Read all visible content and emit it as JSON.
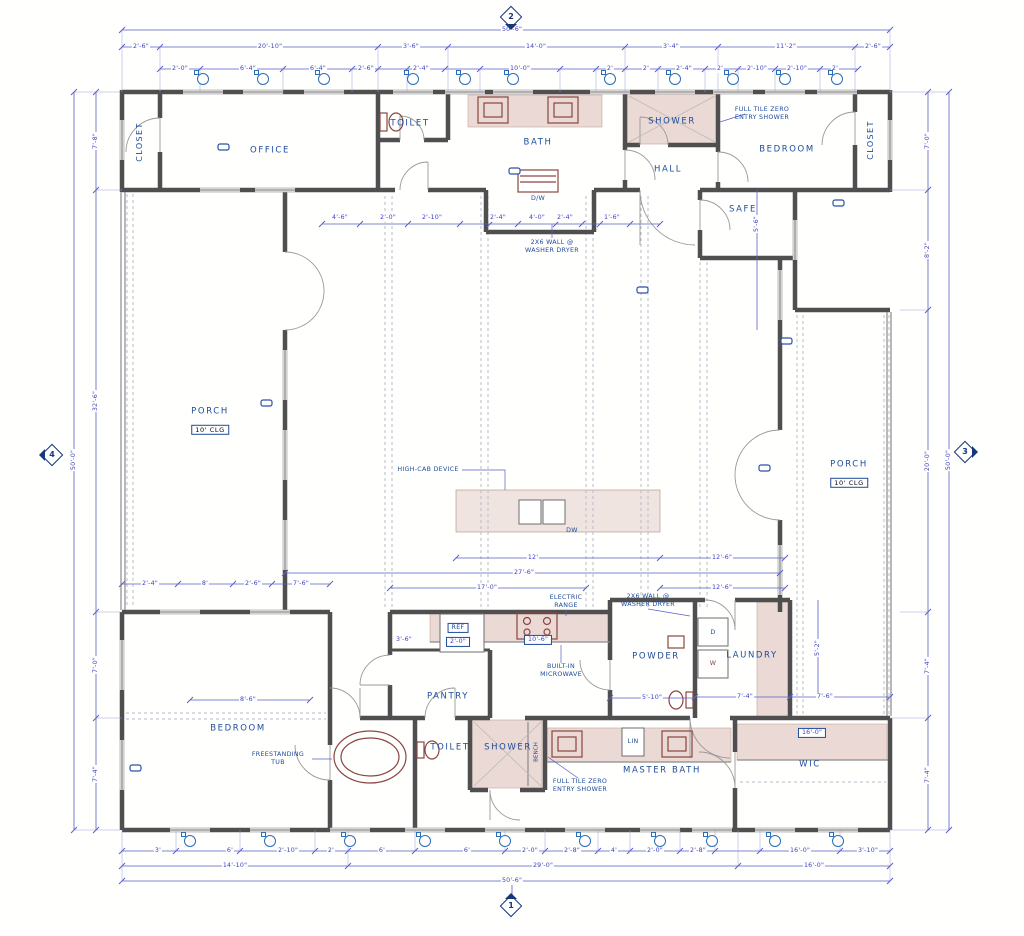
{
  "colors": {
    "wall": "#4f4f4f",
    "dimension_lines": "#5b5fc9",
    "dimension_text": "#3a3fc0",
    "room_label": "#1d4b9b",
    "fixture_red": "#8a4540",
    "tile_fill": "#ead9d4",
    "window_tag": "#2a6db5",
    "background": "#ffffff"
  },
  "markers": {
    "top": {
      "num": "2"
    },
    "bottom": {
      "num": "1"
    },
    "left": {
      "num": "4"
    },
    "right": {
      "num": "3"
    }
  },
  "window_tags": {
    "top": {
      "y": 79,
      "xs": [
        203,
        263,
        324,
        413,
        465,
        513,
        610,
        675,
        733,
        785,
        837
      ]
    },
    "bottom": {
      "y": 841,
      "xs": [
        190,
        270,
        350,
        425,
        505,
        585,
        660,
        712,
        775,
        838
      ]
    }
  },
  "labels": [
    {
      "n": "room-closet-top-left",
      "t": "CLOSET",
      "x": 140,
      "y": 142,
      "c": "roomv"
    },
    {
      "n": "room-office",
      "t": "OFFICE",
      "x": 270,
      "y": 151,
      "c": "room"
    },
    {
      "n": "room-toilet-top",
      "t": "TOILET",
      "x": 410,
      "y": 124,
      "c": "room"
    },
    {
      "n": "room-bath",
      "t": "BATH",
      "x": 538,
      "y": 143,
      "c": "room"
    },
    {
      "n": "room-shower-top",
      "t": "SHOWER",
      "x": 672,
      "y": 122,
      "c": "room"
    },
    {
      "n": "room-hall",
      "t": "HALL",
      "x": 668,
      "y": 170,
      "c": "room"
    },
    {
      "n": "room-bedroom-top-right",
      "t": "BEDROOM",
      "x": 787,
      "y": 150,
      "c": "room"
    },
    {
      "n": "room-closet-top-right",
      "t": "CLOSET",
      "x": 871,
      "y": 140,
      "c": "roomv"
    },
    {
      "n": "room-safe",
      "t": "SAFE",
      "x": 743,
      "y": 210,
      "c": "room"
    },
    {
      "n": "room-porch-left",
      "t": "PORCH",
      "x": 210,
      "y": 412,
      "c": "room"
    },
    {
      "n": "porch-left-ceiling",
      "t": "10' CLG",
      "x": 210,
      "y": 430,
      "c": "clg box",
      "col": "#1d4b9b"
    },
    {
      "n": "room-porch-right",
      "t": "PORCH",
      "x": 849,
      "y": 465,
      "c": "room"
    },
    {
      "n": "porch-right-ceiling",
      "t": "10' CLG",
      "x": 849,
      "y": 483,
      "c": "clg box"
    },
    {
      "n": "room-pantry",
      "t": "PANTRY",
      "x": 448,
      "y": 697,
      "c": "room"
    },
    {
      "n": "room-powder",
      "t": "POWDER",
      "x": 656,
      "y": 657,
      "c": "room"
    },
    {
      "n": "room-laundry",
      "t": "LAUNDRY",
      "x": 752,
      "y": 656,
      "c": "room"
    },
    {
      "n": "room-bedroom-bottom-left",
      "t": "BEDROOM",
      "x": 238,
      "y": 729,
      "c": "room"
    },
    {
      "n": "room-toilet-bottom",
      "t": "TOILET",
      "x": 450,
      "y": 748,
      "c": "room"
    },
    {
      "n": "room-shower-bottom",
      "t": "SHOWER",
      "x": 508,
      "y": 748,
      "c": "room"
    },
    {
      "n": "room-master-bath",
      "t": "MASTER BATH",
      "x": 662,
      "y": 771,
      "c": "room"
    },
    {
      "n": "room-wic",
      "t": "WIC",
      "x": 810,
      "y": 765,
      "c": "room"
    },
    {
      "n": "note-full-tile-shower-top",
      "t": "FULL TILE ZERO\nENTRY SHOWER",
      "x": 762,
      "y": 114,
      "c": "note"
    },
    {
      "n": "note-washer-dryer-wall-top",
      "t": "2X6 WALL @\nWASHER DRYER",
      "x": 552,
      "y": 247,
      "c": "note"
    },
    {
      "n": "note-high-cab",
      "t": "HIGH-CAB DEVICE",
      "x": 428,
      "y": 470,
      "c": "note"
    },
    {
      "n": "note-electric-range",
      "t": "ELECTRIC\nRANGE",
      "x": 566,
      "y": 602,
      "c": "note"
    },
    {
      "n": "note-washer-dryer-wall-laundry",
      "t": "2X6 WALL @\nWASHER DRYER",
      "x": 648,
      "y": 601,
      "c": "note"
    },
    {
      "n": "note-built-in-microwave",
      "t": "BUILT-IN\nMICROWAVE",
      "x": 561,
      "y": 671,
      "c": "note"
    },
    {
      "n": "note-freestanding-tub",
      "t": "FREESTANDING\nTUB",
      "x": 278,
      "y": 759,
      "c": "note"
    },
    {
      "n": "note-full-tile-shower-bottom",
      "t": "FULL TILE ZERO\nENTRY SHOWER",
      "x": 580,
      "y": 786,
      "c": "note"
    },
    {
      "n": "label-ref",
      "t": "REF",
      "x": 458,
      "y": 628,
      "c": "note box"
    },
    {
      "n": "dim-ref",
      "t": "2'-0\"",
      "x": 458,
      "y": 642,
      "c": "dim box"
    },
    {
      "n": "label-dishwasher",
      "t": "DW",
      "x": 572,
      "y": 531,
      "c": "note"
    },
    {
      "n": "label-washer-dryer-stack",
      "t": "D/W",
      "x": 538,
      "y": 199,
      "c": "note"
    },
    {
      "n": "label-dryer",
      "t": "D",
      "x": 713,
      "y": 633,
      "c": "note"
    },
    {
      "n": "label-washer",
      "t": "W",
      "x": 713,
      "y": 664,
      "c": "note red"
    },
    {
      "n": "label-linen",
      "t": "LIN",
      "x": 633,
      "y": 742,
      "c": "note"
    },
    {
      "n": "label-bench",
      "t": "BENCH",
      "x": 537,
      "y": 752,
      "c": "notev"
    },
    {
      "n": "dim",
      "t": "50'-6\"",
      "x": 512,
      "y": 30,
      "c": "dim"
    },
    {
      "n": "dim",
      "t": "2'-6\"",
      "x": 141,
      "y": 47,
      "c": "dim"
    },
    {
      "n": "dim",
      "t": "20'-10\"",
      "x": 270,
      "y": 47,
      "c": "dim"
    },
    {
      "n": "dim",
      "t": "3'-6\"",
      "x": 411,
      "y": 47,
      "c": "dim"
    },
    {
      "n": "dim",
      "t": "14'-0\"",
      "x": 536,
      "y": 47,
      "c": "dim"
    },
    {
      "n": "dim",
      "t": "3'-4\"",
      "x": 671,
      "y": 47,
      "c": "dim"
    },
    {
      "n": "dim",
      "t": "11'-2\"",
      "x": 786,
      "y": 47,
      "c": "dim"
    },
    {
      "n": "dim",
      "t": "2'-6\"",
      "x": 873,
      "y": 47,
      "c": "dim"
    },
    {
      "n": "dim",
      "t": "2'-0\"",
      "x": 180,
      "y": 69,
      "c": "dim"
    },
    {
      "n": "dim",
      "t": "6'-4\"",
      "x": 248,
      "y": 69,
      "c": "dim"
    },
    {
      "n": "dim",
      "t": "6'-4\"",
      "x": 318,
      "y": 69,
      "c": "dim"
    },
    {
      "n": "dim",
      "t": "2'-6\"",
      "x": 366,
      "y": 69,
      "c": "dim"
    },
    {
      "n": "dim",
      "t": "2'-4\"",
      "x": 421,
      "y": 69,
      "c": "dim"
    },
    {
      "n": "dim",
      "t": "10'-0\"",
      "x": 520,
      "y": 69,
      "c": "dim"
    },
    {
      "n": "dim",
      "t": "2'",
      "x": 610,
      "y": 69,
      "c": "dim"
    },
    {
      "n": "dim",
      "t": "2'",
      "x": 646,
      "y": 69,
      "c": "dim"
    },
    {
      "n": "dim",
      "t": "2'-4\"",
      "x": 684,
      "y": 69,
      "c": "dim"
    },
    {
      "n": "dim",
      "t": "2'",
      "x": 720,
      "y": 69,
      "c": "dim"
    },
    {
      "n": "dim",
      "t": "2'-10\"",
      "x": 757,
      "y": 69,
      "c": "dim"
    },
    {
      "n": "dim",
      "t": "2'-10\"",
      "x": 797,
      "y": 69,
      "c": "dim"
    },
    {
      "n": "dim",
      "t": "2'",
      "x": 835,
      "y": 69,
      "c": "dim"
    },
    {
      "n": "dim",
      "t": "3'",
      "x": 158,
      "y": 851,
      "c": "dim"
    },
    {
      "n": "dim",
      "t": "6'",
      "x": 230,
      "y": 851,
      "c": "dim"
    },
    {
      "n": "dim",
      "t": "2'-10\"",
      "x": 288,
      "y": 851,
      "c": "dim"
    },
    {
      "n": "dim",
      "t": "2'",
      "x": 331,
      "y": 851,
      "c": "dim"
    },
    {
      "n": "dim",
      "t": "6'",
      "x": 382,
      "y": 851,
      "c": "dim"
    },
    {
      "n": "dim",
      "t": "6'",
      "x": 467,
      "y": 851,
      "c": "dim"
    },
    {
      "n": "dim",
      "t": "2'-0\"",
      "x": 530,
      "y": 851,
      "c": "dim"
    },
    {
      "n": "dim",
      "t": "2'-8\"",
      "x": 572,
      "y": 851,
      "c": "dim"
    },
    {
      "n": "dim",
      "t": "4'",
      "x": 614,
      "y": 851,
      "c": "dim"
    },
    {
      "n": "dim",
      "t": "2'-0\"",
      "x": 655,
      "y": 851,
      "c": "dim"
    },
    {
      "n": "dim",
      "t": "2'-8\"",
      "x": 698,
      "y": 851,
      "c": "dim"
    },
    {
      "n": "dim",
      "t": "16'-0\"",
      "x": 800,
      "y": 851,
      "c": "dim"
    },
    {
      "n": "dim",
      "t": "3'-10\"",
      "x": 868,
      "y": 851,
      "c": "dim"
    },
    {
      "n": "dim",
      "t": "14'-10\"",
      "x": 235,
      "y": 866,
      "c": "dim"
    },
    {
      "n": "dim",
      "t": "29'-0\"",
      "x": 543,
      "y": 866,
      "c": "dim"
    },
    {
      "n": "dim",
      "t": "16'-0\"",
      "x": 814,
      "y": 866,
      "c": "dim"
    },
    {
      "n": "dim",
      "t": "50'-6\"",
      "x": 512,
      "y": 881,
      "c": "dim"
    },
    {
      "n": "dim",
      "t": "50'-0\"",
      "x": 74,
      "y": 460,
      "c": "dim r"
    },
    {
      "n": "dim",
      "t": "7'-8\"",
      "x": 96,
      "y": 141,
      "c": "dim r"
    },
    {
      "n": "dim",
      "t": "32'-6\"",
      "x": 96,
      "y": 401,
      "c": "dim r"
    },
    {
      "n": "dim",
      "t": "7'-0\"",
      "x": 96,
      "y": 665,
      "c": "dim r"
    },
    {
      "n": "dim",
      "t": "7'-4\"",
      "x": 96,
      "y": 774,
      "c": "dim r"
    },
    {
      "n": "dim",
      "t": "50'-0\"",
      "x": 949,
      "y": 460,
      "c": "dim r"
    },
    {
      "n": "dim",
      "t": "7'-0\"",
      "x": 928,
      "y": 141,
      "c": "dim r"
    },
    {
      "n": "dim",
      "t": "8'-2\"",
      "x": 928,
      "y": 250,
      "c": "dim r"
    },
    {
      "n": "dim",
      "t": "20'-0\"",
      "x": 928,
      "y": 461,
      "c": "dim r"
    },
    {
      "n": "dim",
      "t": "7'-4\"",
      "x": 928,
      "y": 666,
      "c": "dim r"
    },
    {
      "n": "dim",
      "t": "7'-4\"",
      "x": 928,
      "y": 775,
      "c": "dim r"
    },
    {
      "n": "dim",
      "t": "12'",
      "x": 533,
      "y": 558,
      "c": "dim"
    },
    {
      "n": "dim",
      "t": "12'-6\"",
      "x": 722,
      "y": 558,
      "c": "dim"
    },
    {
      "n": "dim",
      "t": "27'-6\"",
      "x": 524,
      "y": 573,
      "c": "dim"
    },
    {
      "n": "dim",
      "t": "17'-0\"",
      "x": 487,
      "y": 588,
      "c": "dim"
    },
    {
      "n": "dim",
      "t": "12'-6\"",
      "x": 722,
      "y": 588,
      "c": "dim"
    },
    {
      "n": "dim",
      "t": "2'-4\"",
      "x": 150,
      "y": 584,
      "c": "dim"
    },
    {
      "n": "dim",
      "t": "8'",
      "x": 205,
      "y": 584,
      "c": "dim"
    },
    {
      "n": "dim",
      "t": "2'-6\"",
      "x": 253,
      "y": 584,
      "c": "dim"
    },
    {
      "n": "dim",
      "t": "7'-6\"",
      "x": 301,
      "y": 584,
      "c": "dim"
    },
    {
      "n": "dim",
      "t": "8'-6\"",
      "x": 248,
      "y": 700,
      "c": "dim"
    },
    {
      "n": "dim",
      "t": "3'-6\"",
      "x": 404,
      "y": 640,
      "c": "dim"
    },
    {
      "n": "dim",
      "t": "10'-6\"",
      "x": 538,
      "y": 640,
      "c": "dim box"
    },
    {
      "n": "dim",
      "t": "5'-10\"",
      "x": 652,
      "y": 698,
      "c": "dim"
    },
    {
      "n": "dim",
      "t": "7'-4\"",
      "x": 745,
      "y": 697,
      "c": "dim"
    },
    {
      "n": "dim",
      "t": "7'-6\"",
      "x": 825,
      "y": 697,
      "c": "dim"
    },
    {
      "n": "dim",
      "t": "16'-0\"",
      "x": 812,
      "y": 733,
      "c": "dim box"
    },
    {
      "n": "dim",
      "t": "4'-6\"",
      "x": 340,
      "y": 218,
      "c": "dim"
    },
    {
      "n": "dim",
      "t": "2'-0\"",
      "x": 388,
      "y": 218,
      "c": "dim"
    },
    {
      "n": "dim",
      "t": "2'-10\"",
      "x": 432,
      "y": 218,
      "c": "dim"
    },
    {
      "n": "dim",
      "t": "2'-4\"",
      "x": 498,
      "y": 218,
      "c": "dim"
    },
    {
      "n": "dim",
      "t": "4'-0\"",
      "x": 537,
      "y": 218,
      "c": "dim"
    },
    {
      "n": "dim",
      "t": "2'-4\"",
      "x": 565,
      "y": 218,
      "c": "dim"
    },
    {
      "n": "dim",
      "t": "1'-6\"",
      "x": 612,
      "y": 218,
      "c": "dim"
    },
    {
      "n": "dim",
      "t": "5'-6\"",
      "x": 757,
      "y": 224,
      "c": "dim r"
    },
    {
      "n": "dim",
      "t": "5'-2\"",
      "x": 818,
      "y": 648,
      "c": "dim r"
    }
  ]
}
